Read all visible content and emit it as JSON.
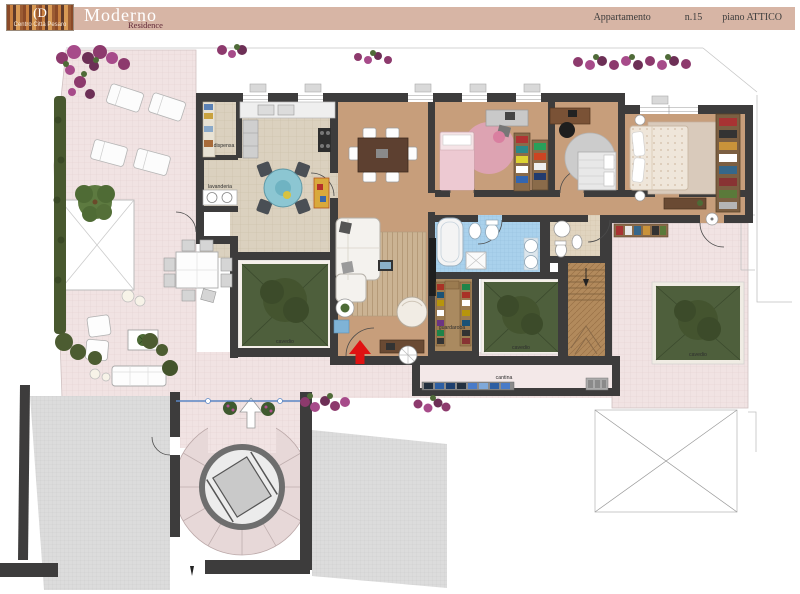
{
  "header": {
    "logo": {
      "symbol": "(D",
      "caption": "Centro Città Pesaro"
    },
    "brand_title": "Moderno",
    "brand_subtitle": "Residence",
    "apartment_label": "Appartamento",
    "apartment_number": "n.15",
    "floor_label": "piano ATTICO"
  },
  "plan": {
    "rooms": {
      "dispensa": "dispensa",
      "lavanderia": "lavanderia",
      "guardaroba": "guardaroba",
      "cantina": "cantina",
      "cavedio": "cavedio"
    },
    "colors": {
      "header_bar": "#d7b5a5",
      "wall": "#3d3c3c",
      "terrace_pink": "#f1e3e3",
      "wood_floor": "#c79e7b",
      "kitchen_tile": "#dbd1bf",
      "bath_blue": "#a9d1ec",
      "bath_beige": "#e0d4bf",
      "cavedio_green": "#4e5f3c",
      "flowers": "#8d3a6d",
      "entrance_arrow": "#e01212"
    }
  }
}
